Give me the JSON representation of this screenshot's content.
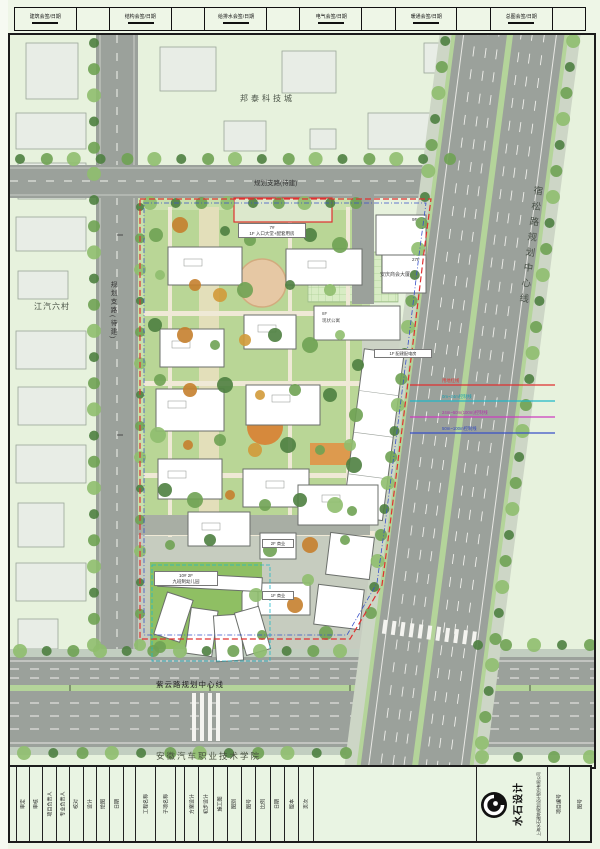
{
  "signoff": {
    "items": [
      "建筑会签/日期",
      "结构会签/日期",
      "给排水会签/日期",
      "电气会签/日期",
      "暖通会签/日期",
      "总图会签/日期"
    ]
  },
  "site": {
    "areas": {
      "bangtai": "邦泰科技城",
      "jiangqi": "江汽六村",
      "college": "安徽汽车职业技术学院"
    },
    "roads": {
      "left_road": "规划支路(待建)",
      "top_road": "规划支路(待建)",
      "susong": "宿松路规划中心线",
      "ziyun": "紫云路规划中心线"
    },
    "buildings": {
      "entrance_no": "7#",
      "entrance_use": "1F 入口大堂+配套用房",
      "anqing_name": "安庆商会大厦",
      "anqing_f1": "9F",
      "anqing_f2": "27F",
      "apartment_f": "8F",
      "apartment_name": "现状公寓",
      "kindergarten_no": "10# 2F",
      "kindergarten_name": "九班制幼儿园",
      "power_room": "1F 配建配电房",
      "shop1": "2F 商业",
      "shop2": "1F 商业"
    },
    "control_lines": {
      "red": "用地红线",
      "cyan": "0m~24m控制线",
      "magenta": "24m~50m(100m)控制线",
      "blue": "50m~100m控制线"
    }
  },
  "titleblock": {
    "fields_a": [
      "审定",
      "审核",
      "项目负责人",
      "专业负责人",
      "校对",
      "设计",
      "绘图",
      "日期"
    ],
    "fields_b": [
      "工程名称",
      "子项名称"
    ],
    "fields_c": [
      "方案设计",
      "初步设计",
      "施工图",
      "图别",
      "图号",
      "比例",
      "日期",
      "版本",
      "页次"
    ],
    "logo_text": "水石设计",
    "company": "上海水石建筑规划设计股份有限公司",
    "right_fields": [
      "项目编号",
      "图号"
    ]
  },
  "colors": {
    "red_line": "#e03030",
    "blue_line": "#3850c8",
    "cyan_line": "#20b8c8",
    "magenta_line": "#cc3cc0",
    "road_gray": "#9ba19b",
    "median_green": "#b4d49a"
  }
}
